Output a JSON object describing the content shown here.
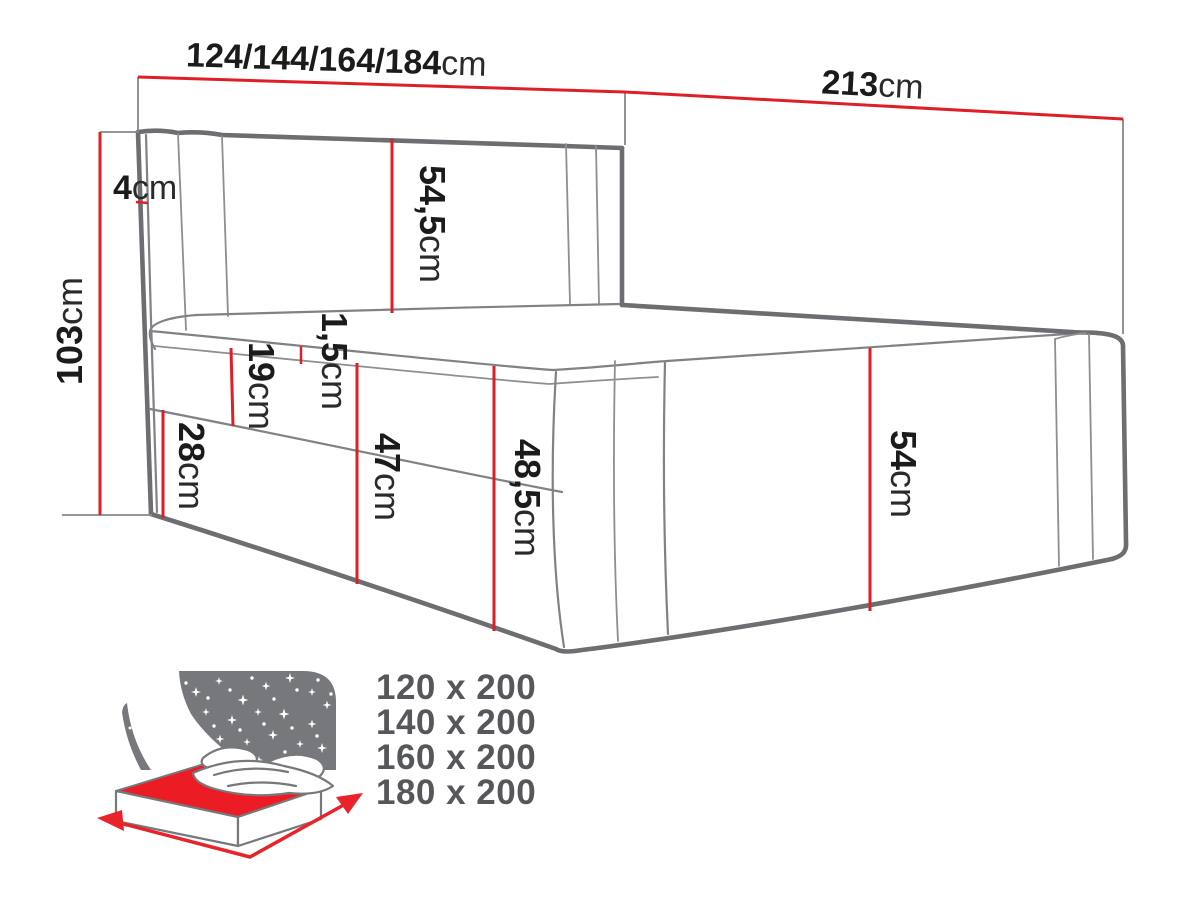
{
  "diagram": {
    "title_hint": "boxspring-bed-dimension-drawing",
    "unit": "cm",
    "dimensions": {
      "width_options": {
        "value": "124/144/164/184",
        "unit": "cm"
      },
      "length": {
        "value": "213",
        "unit": "cm"
      },
      "total_height": {
        "value": "103",
        "unit": "cm"
      },
      "headboard_side_thickness": {
        "value": "4",
        "unit": "cm"
      },
      "headboard_panel_height": {
        "value": "54,5",
        "unit": "cm"
      },
      "topper_thickness": {
        "value": "1,5",
        "unit": "cm"
      },
      "mattress_height": {
        "value": "19",
        "unit": "cm"
      },
      "base_height_head": {
        "value": "28",
        "unit": "cm"
      },
      "side_height": {
        "value": "47",
        "unit": "cm"
      },
      "corner_height": {
        "value": "48,5",
        "unit": "cm"
      },
      "foot_height": {
        "value": "54",
        "unit": "cm"
      }
    },
    "available_sizes": [
      "120 x 200",
      "140 x 200",
      "160 x 200",
      "180 x 200"
    ],
    "icon": "bed-with-starry-night-icon",
    "colors": {
      "dimension_red": "#df1f26",
      "outline_gray": "#6d6e71",
      "seam_gray": "#8d8f92",
      "label_black": "#1b1b19",
      "sizes_text_gray": "#55575a",
      "icon_gray": "#77787b",
      "icon_red": "#ec1c24",
      "background": "#ffffff"
    }
  }
}
